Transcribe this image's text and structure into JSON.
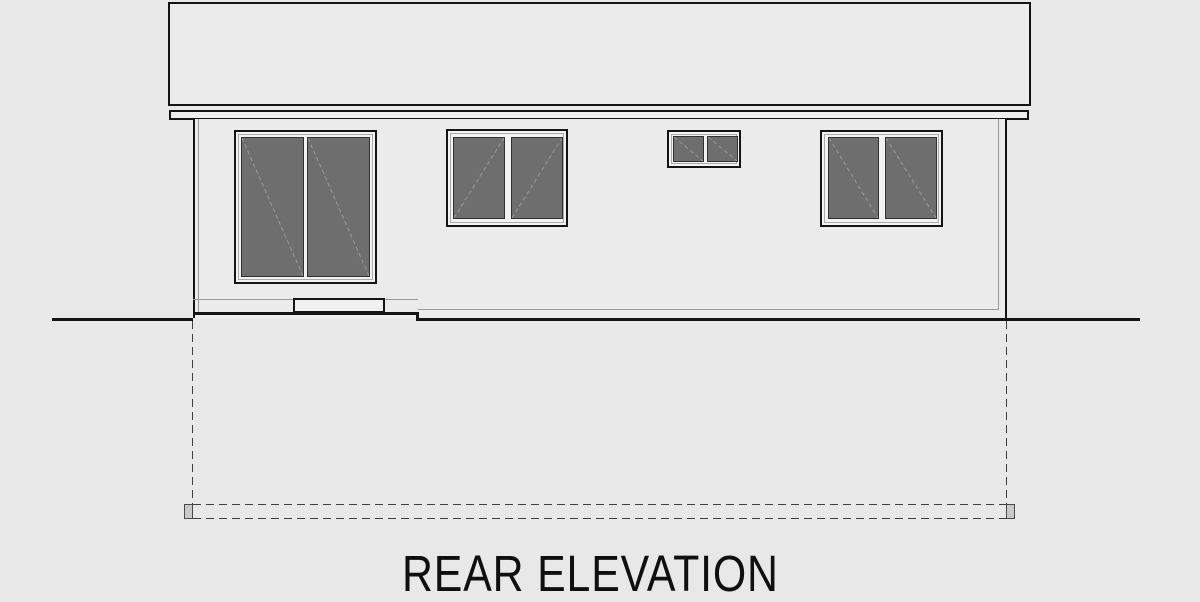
{
  "title": {
    "text": "REAR ELEVATION"
  },
  "drawing": {
    "type": "architectural-elevation",
    "colors": {
      "background": "#e8e8e8",
      "surface": "#ebebeb",
      "frame": "#f2f2f2",
      "glass": "#6e6e6e",
      "line_dark": "#141414",
      "line_gray": "#999999",
      "diagonal": "#9a9a9a",
      "dash": "#3f3f3f"
    },
    "elements": {
      "roof": {
        "label": "flat roof slab with fascia"
      },
      "wall": {
        "label": "rear wall"
      },
      "sliding_door": {
        "label": "sliding glass door",
        "panels": 2
      },
      "window_left": {
        "label": "two-pane slider window",
        "panes": 2
      },
      "window_small": {
        "label": "small two-pane window",
        "panes": 2
      },
      "window_right": {
        "label": "two-pane slider window",
        "panes": 2
      },
      "threshold": {
        "label": "door threshold step"
      },
      "grade": {
        "label": "finish grade line"
      },
      "foundation": {
        "label": "foundation footing (dashed, below grade)"
      }
    }
  }
}
